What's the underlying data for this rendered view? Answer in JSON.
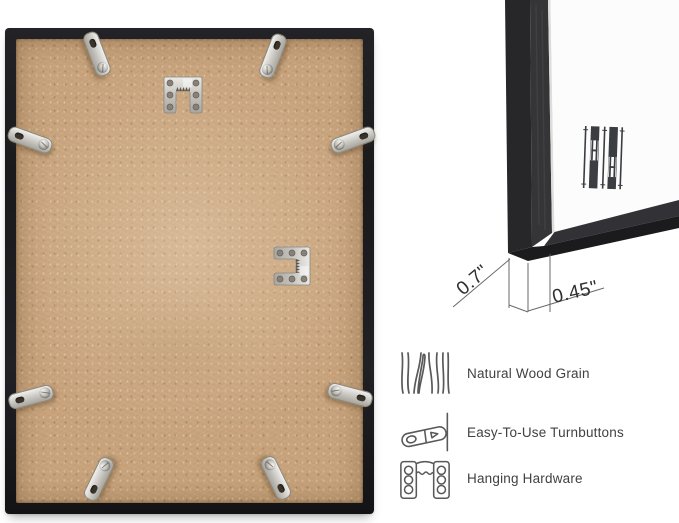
{
  "dimensions": {
    "frame_depth": "0.7\"",
    "frame_face_width": "0.45\""
  },
  "features": [
    {
      "icon": "wood-grain-icon",
      "label": "Natural Wood Grain"
    },
    {
      "icon": "turnbutton-icon",
      "label": "Easy-To-Use Turnbuttons"
    },
    {
      "icon": "hanging-hardware-icon",
      "label": "Hanging Hardware"
    }
  ],
  "hardware": {
    "turnbuttons_visible": 8,
    "hanging_brackets_visible": 2
  },
  "colors": {
    "frame_black": "#1d1d20",
    "backing_board_tan": "#c7a27b",
    "metal_silver": "#d6d4ce",
    "mat_white": "#fcfcfc",
    "text_dark": "#414141",
    "line_gray": "#59595b"
  }
}
